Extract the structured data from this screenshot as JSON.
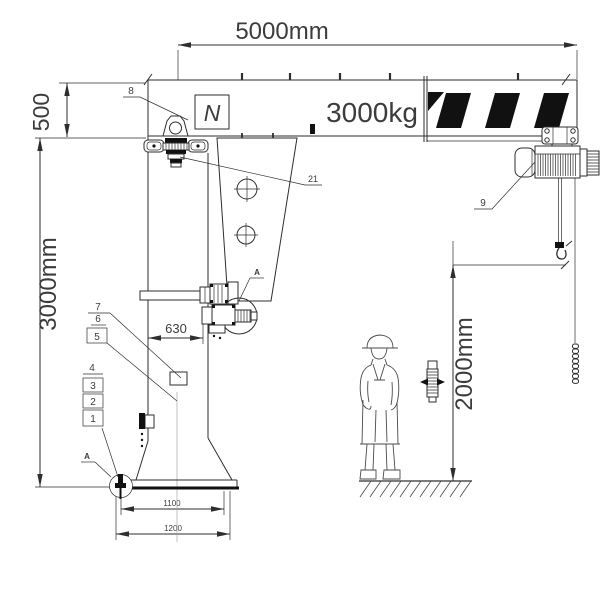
{
  "texts": {
    "dim_span": "5000mm",
    "dim_beam_height": "500",
    "dim_column_height": "3000mm",
    "dim_column_width": "630",
    "dim_hook_height": "2000mm",
    "dim_base_bolts": "1100",
    "dim_base_plate": "1200",
    "capacity": "3000kg",
    "motor_symbol": "N"
  },
  "part_labels": {
    "p1": "1",
    "p2": "2",
    "p3": "3",
    "p4": "4",
    "p5": "5",
    "p6": "6",
    "p7": "7",
    "p8": "8",
    "p9": "9",
    "p21": "21"
  },
  "detail_labels": {
    "a_slew": "A",
    "a_anchor": "A"
  }
}
